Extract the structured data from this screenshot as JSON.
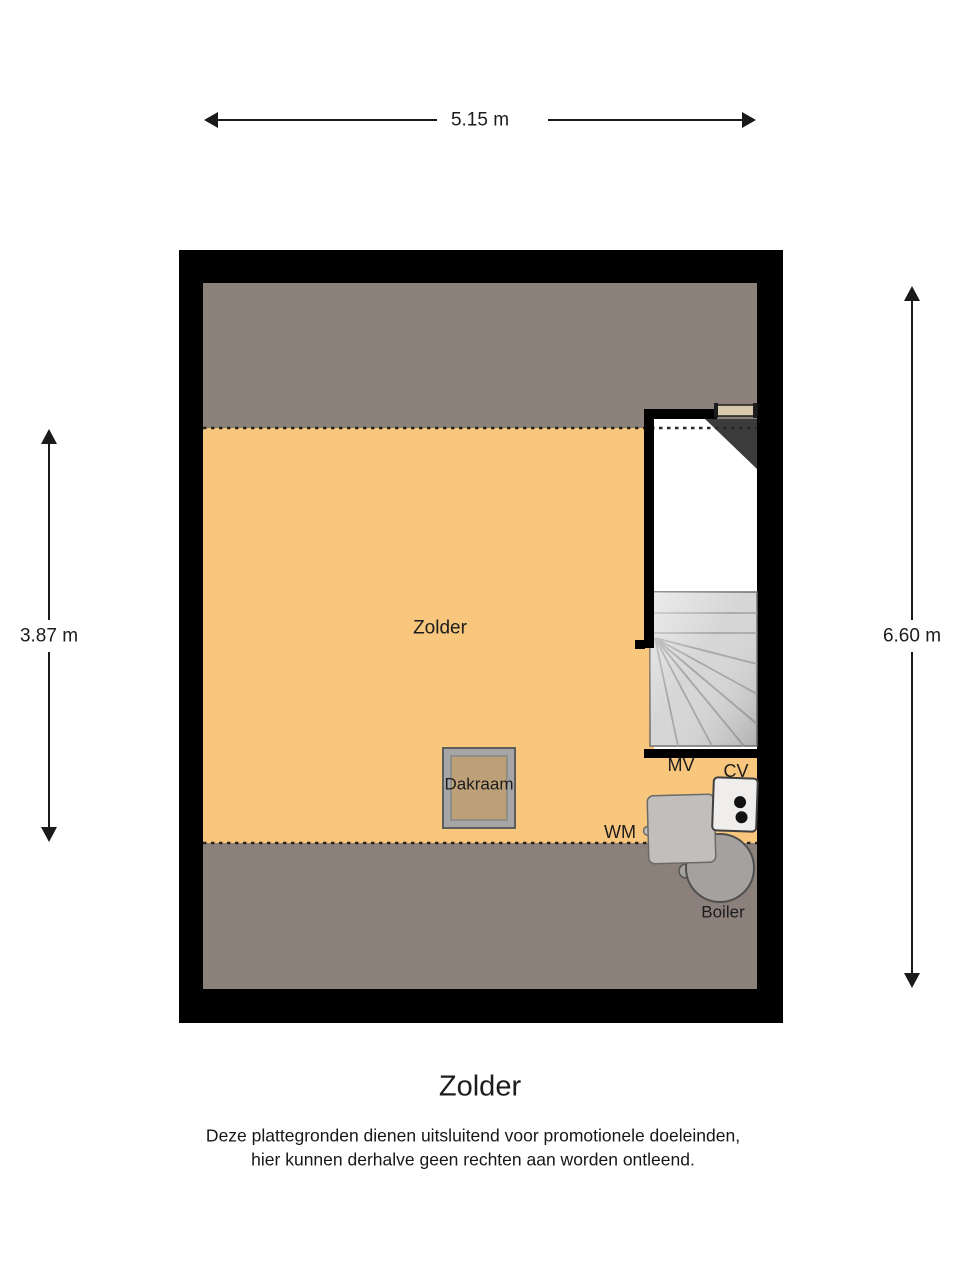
{
  "plan": {
    "room_label": "Zolder",
    "dimensions": {
      "width_top": "5.15 m",
      "height_left": "3.87 m",
      "height_right": "6.60 m"
    },
    "fixtures": {
      "dakraam": "Dakraam",
      "mv": "MV",
      "cv": "CV",
      "wm": "WM",
      "boiler": "Boiler"
    }
  },
  "footer": {
    "title": "Zolder",
    "disclaimer_line1": "Deze plattegronden dienen uitsluitend voor promotionele doeleinden,",
    "disclaimer_line2": "hier kunnen derhalve geen rechten aan worden ontleend."
  },
  "colors": {
    "floor": "#f8c77d",
    "low_headroom": "#8c807b",
    "wall": "#000000",
    "stair_tread": "#d6d6d6",
    "under_stairs": "#3b3b3b",
    "window_bar": "#d8c9ac",
    "dakraam_frame": "#a6a6a6",
    "dakraam_glass": "#bda078",
    "wm": "#c1bebc",
    "boiler": "#a5a19f",
    "cv": "#f0eeec",
    "dim_line": "#1a1a1a"
  }
}
